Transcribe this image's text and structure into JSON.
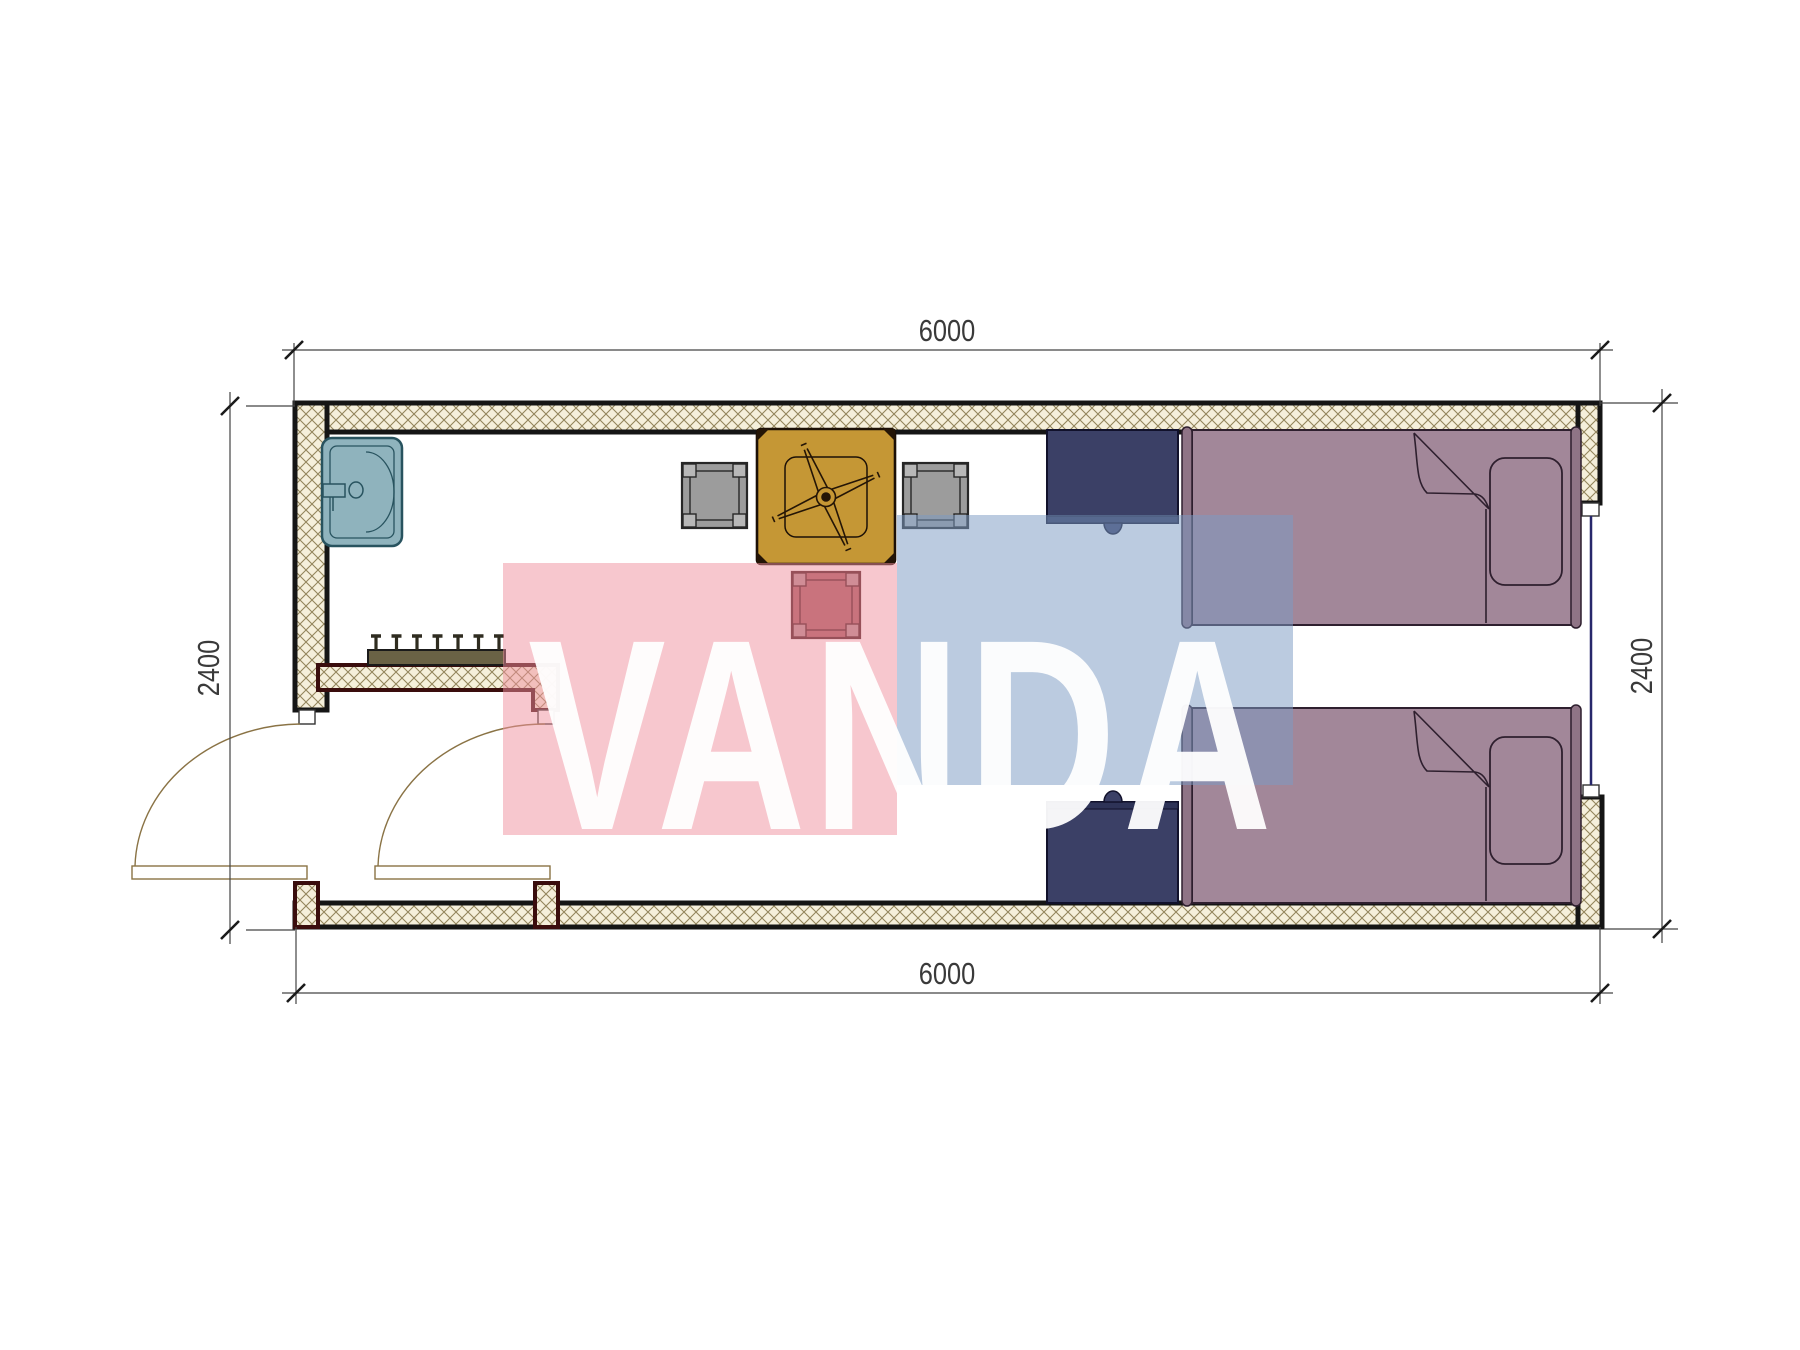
{
  "page": {
    "title": "Container room floor plan",
    "background": "#ffffff"
  },
  "dimensions": {
    "top": {
      "label": "6000"
    },
    "bottom": {
      "label": "6000"
    },
    "left": {
      "label": "2400"
    },
    "right": {
      "label": "2400"
    }
  },
  "watermark": {
    "text": "VANDA",
    "pink_color": "#ef8f9e",
    "blue_color": "#7d9cc4",
    "text_color": "#ffffff"
  },
  "plan": {
    "wall_fill": "#f5efdb",
    "wall_hatch_line": "#93855c",
    "wall_edge": "#151515",
    "partition_edge": "#3a0d0d",
    "dimension_line": "#444444",
    "dimension_text": "#3a3a3a",
    "furniture": {
      "sink": {
        "color": "#8fb3bd",
        "outline": "#28535f"
      },
      "coat_rack": {
        "color": "#6a6245",
        "hooks": 7
      },
      "dining_table": {
        "color": "#c59735"
      },
      "chairs": {
        "gray": "#9c9c9c",
        "red": "#a3565c",
        "gray_count": 2,
        "red_count": 1
      },
      "nightstands": {
        "color": "#3b4066",
        "count": 2
      },
      "beds": {
        "color": "#a28799",
        "count": 2
      },
      "window": {
        "glass_color": "#27276b"
      },
      "doors": {
        "swing_color": "#8a7345",
        "count": 2
      }
    }
  }
}
